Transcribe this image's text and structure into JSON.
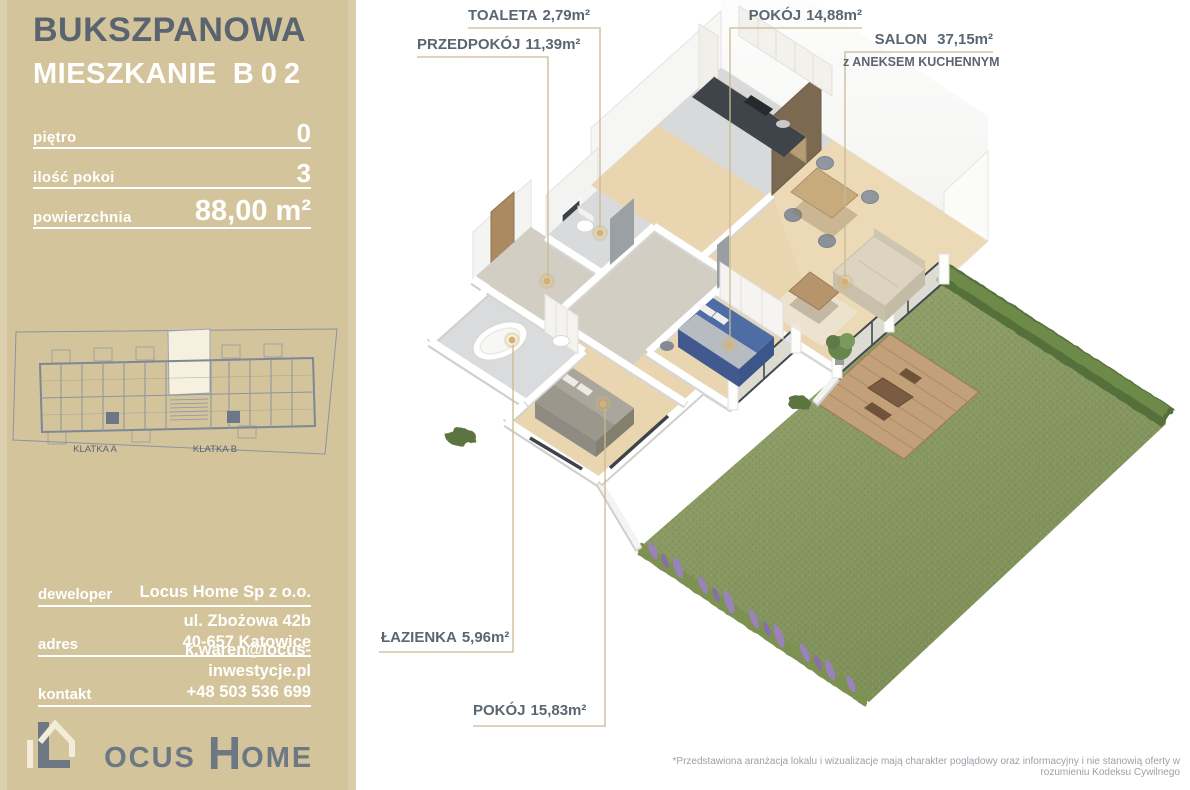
{
  "sidebar": {
    "street": "BUKSZPANOWA",
    "unit_word": "MIESZKANIE",
    "unit_code": "B02",
    "specs": [
      {
        "label": "piętro",
        "value": "0"
      },
      {
        "label": "ilość pokoi",
        "value": "3"
      },
      {
        "label": "powierzchnia",
        "value": "88,00 m²"
      }
    ],
    "map": {
      "klatka_a": "KLATKA A",
      "klatka_b": "KLATKA B"
    },
    "contact": [
      {
        "label": "deweloper",
        "line1": "Locus Home Sp z o.o."
      },
      {
        "label": "adres",
        "line1": "ul. Zbożowa 42b",
        "line2": "40-657 Katowice"
      },
      {
        "label": "kontakt",
        "line1": "k.waren@locus-inwestycje.pl",
        "line2": "+48 503 536 699"
      }
    ],
    "logo": {
      "l1": "L",
      "rest1": "OCUS",
      "l2": "H",
      "rest2": "OME"
    }
  },
  "plan": {
    "rooms": [
      {
        "name": "TOALETA",
        "area": "2,79m²"
      },
      {
        "name": "PRZEDPOKÓJ",
        "area": "11,39m²"
      },
      {
        "name": "POKÓJ",
        "area": "14,88m²"
      },
      {
        "name": "SALON",
        "area": "37,15m²",
        "subtitle": "z ANEKSEM KUCHENNYM"
      },
      {
        "name": "ŁAZIENKA",
        "area": "5,96m²"
      },
      {
        "name": "POKÓJ",
        "area": "15,83m²"
      }
    ],
    "disclaimer": "*Przedstawiona aranżacja lokalu i wizualizacje mają charakter poglądowy oraz informacyjny i nie stanowią oferty w rozumieniu Kodeksu Cywilnego"
  },
  "colors": {
    "sidebar_bg": "#d3c49b",
    "title_text": "#59646f",
    "label_text": "#5b6672",
    "leader_line": "#c9ba92",
    "light_dot": "#d7b26b",
    "grass": "#8b9a64",
    "hedge": "#5e7a41",
    "wood_floor": "#e9d6b1",
    "logo_gray": "#6d7884"
  }
}
